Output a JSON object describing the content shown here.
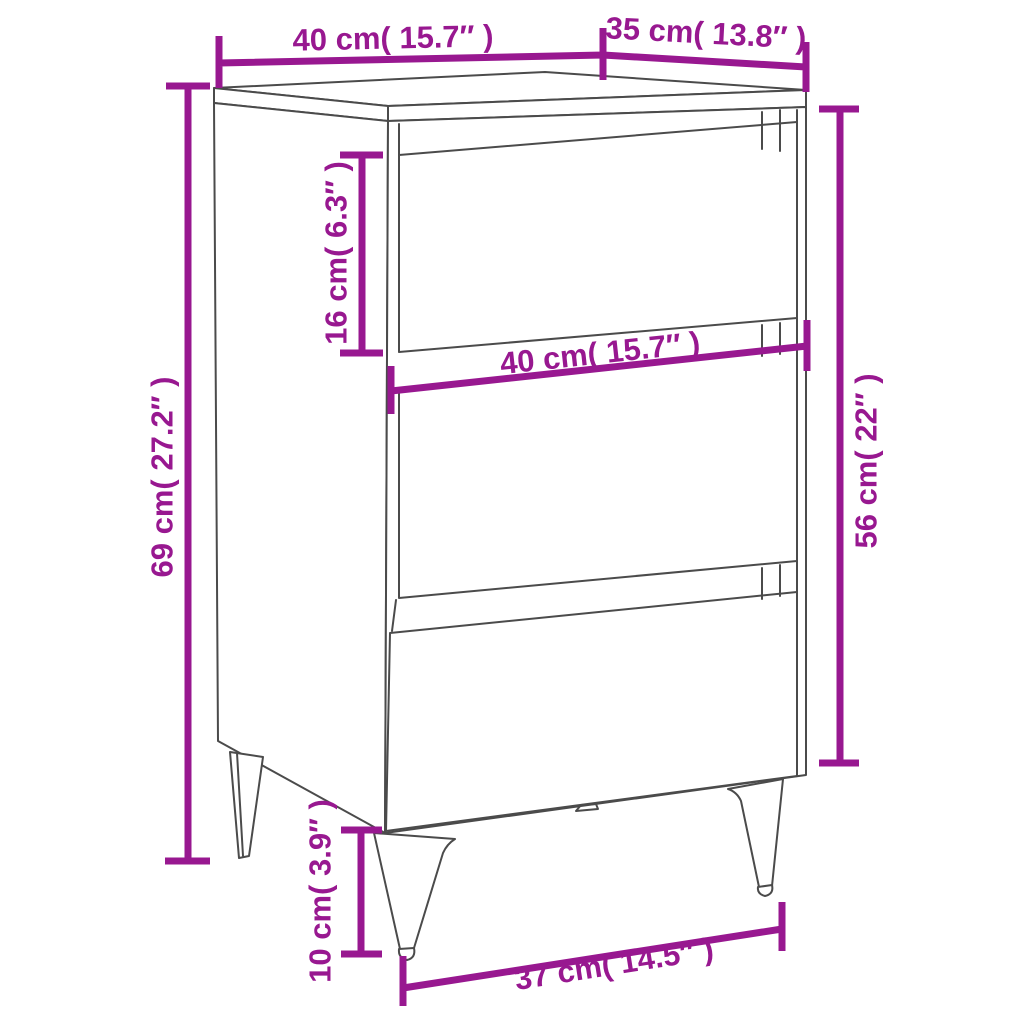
{
  "diagram": {
    "subject": "Bedside cabinet with 3 drawers and metal legs",
    "colors": {
      "dimension_magenta": "#981890",
      "outline_gray": "#4B4B4B",
      "background": "#FFFFFF"
    },
    "dims": {
      "top_width": {
        "label": "40 cm( 15.7″ )",
        "cm": 40,
        "inch": "15.7″"
      },
      "top_depth": {
        "label": "35 cm( 13.8″ )",
        "cm": 35,
        "inch": "13.8″"
      },
      "total_height": {
        "label": "69 cm( 27.2″ )",
        "cm": 69,
        "inch": "27.2″"
      },
      "drawer_height": {
        "label": "16 cm( 6.3″ )",
        "cm": 16,
        "inch": "6.3″"
      },
      "middle_width": {
        "label": "40 cm( 15.7″ )",
        "cm": 40,
        "inch": "15.7″"
      },
      "body_height": {
        "label": "56 cm( 22″ )",
        "cm": 56,
        "inch": "22″"
      },
      "leg_height": {
        "label": "10 cm( 3.9″ )",
        "cm": 10,
        "inch": "3.9″"
      },
      "bottom_width": {
        "label": "37 cm( 14.5″ )",
        "cm": 37,
        "inch": "14.5″"
      }
    }
  }
}
